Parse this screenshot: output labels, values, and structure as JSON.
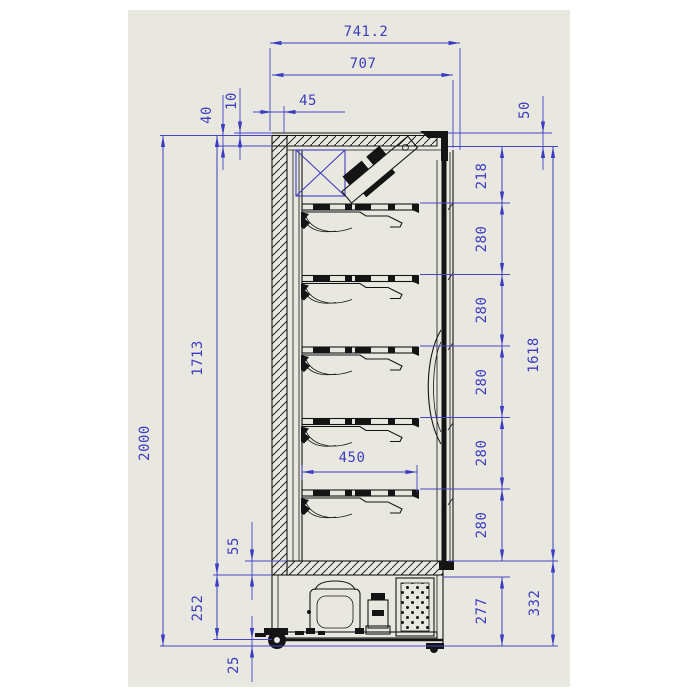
{
  "drawing": {
    "type": "side-section technical drawing of upright display cooler",
    "units": "mm"
  },
  "colors": {
    "page_background": "#ffffff",
    "canvas_background": "#e9e8e0",
    "dimension_blue": "#3c3cc0",
    "object_black": "#141414"
  },
  "dims": {
    "total_depth": "741.2",
    "case_depth": "707",
    "top_rear_offset": "45",
    "lid_gap": "10",
    "top_insulation": "40",
    "front_top_height": "50",
    "first_shelf_drop": "218",
    "shelf_spacing": "280",
    "shelf_stack_height": "1618",
    "base_section_height": "332",
    "machine_bay_height": "277",
    "total_height": "2000",
    "interior_height": "1713",
    "shelf_depth": "450",
    "deck_thickness": "55",
    "base_frame_height": "252",
    "floor_clearance": "25"
  }
}
